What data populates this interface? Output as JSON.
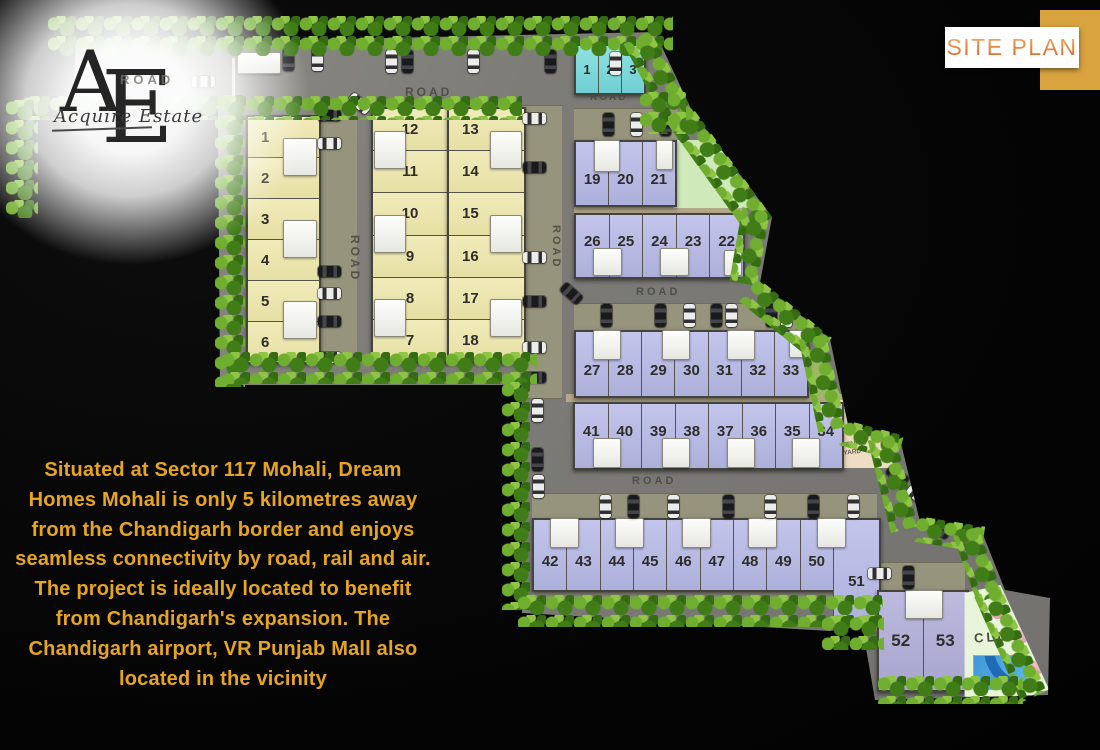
{
  "badge": {
    "title": "SITE PLAN"
  },
  "logo": {
    "letter_a": "A",
    "letter_e": "E",
    "script": "Acquire Estate"
  },
  "roads": {
    "label": "ROAD"
  },
  "areas": {
    "club": "CLUB",
    "tennis": "TENNIS YARD"
  },
  "plots": {
    "teal": [
      "1",
      "2",
      "3"
    ],
    "yellowA": [
      "1",
      "2",
      "3",
      "4",
      "5",
      "6"
    ],
    "yellowB": [
      "12",
      "11",
      "10",
      "9",
      "8",
      "7"
    ],
    "yellowC": [
      "13",
      "14",
      "15",
      "16",
      "17",
      "18"
    ],
    "purpleA": [
      "19",
      "20",
      "21"
    ],
    "purpleB": [
      "26",
      "25",
      "24",
      "23",
      "22"
    ],
    "purpleC": [
      "27",
      "28",
      "29",
      "30",
      "31",
      "32",
      "33"
    ],
    "purpleD": [
      "41",
      "40",
      "39",
      "38",
      "37",
      "36",
      "35",
      "34"
    ],
    "purpleE": [
      "42",
      "43",
      "44",
      "45",
      "46",
      "47",
      "48",
      "49",
      "50",
      "51"
    ],
    "purpleF": [
      "52",
      "53"
    ]
  },
  "description": {
    "text": "Situated at Sector 117 Mohali, Dream\nHomes Mohali is only 5 kilometres away\nfrom the Chandigarh border and enjoys\nseamless connectivity by road, rail and air.\nThe project is ideally located to benefit\nfrom Chandigarh's expansion. The\nChandigarh airport, VR Punjab Mall also\nlocated in the vicinity"
  },
  "colors": {
    "text_gold": "#e7a51e",
    "badge_orange": "#dd6327",
    "badge_gold_square": "#d9a440",
    "road_gray": "#7d7c77",
    "plot_yellow": "#ece5ad",
    "plot_purple": "#b7badf",
    "plot_teal": "#7fd8d8",
    "tree_green": "#417d17",
    "pool_blue": "#4aa9e2"
  }
}
